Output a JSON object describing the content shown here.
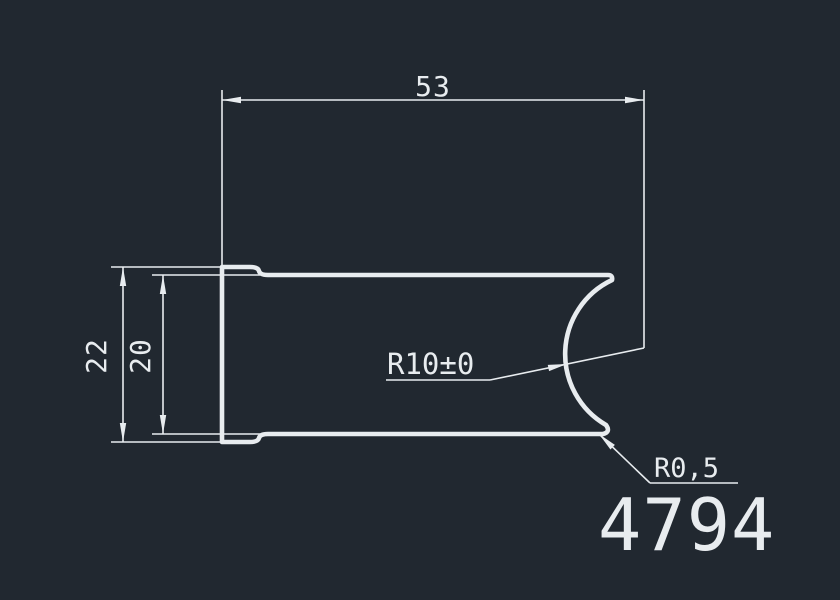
{
  "drawing": {
    "colors": {
      "background": "#212830",
      "line": "#e8ecef",
      "text": "#e8ecef"
    },
    "dimensions": {
      "width": "53",
      "outer_height": "22",
      "inner_height": "20",
      "cove_radius": "R10±0",
      "fillet_radius": "R0,5"
    },
    "part_number": "4794"
  }
}
